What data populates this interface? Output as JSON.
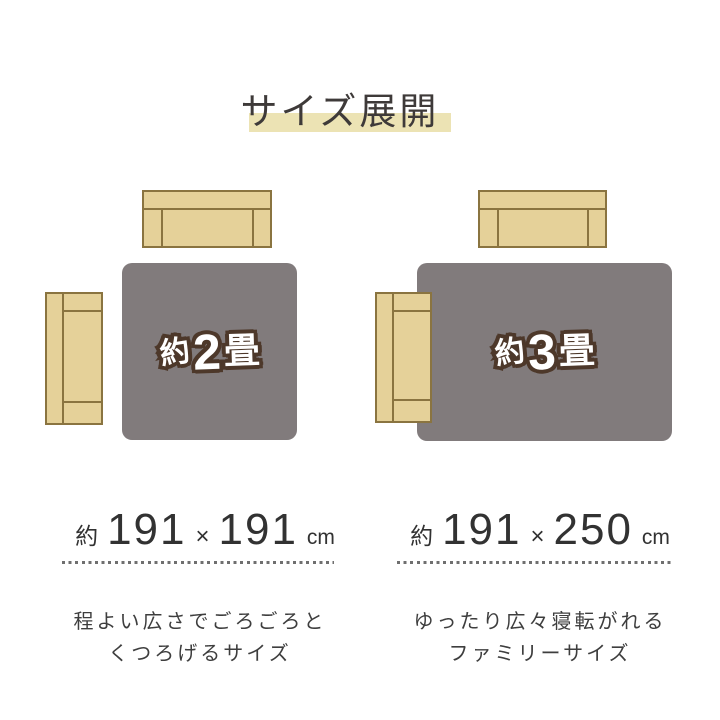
{
  "title": "サイズ展開",
  "colors": {
    "background": "#ffffff",
    "title_text": "#3e3a39",
    "title_highlight": "#ece3b4",
    "rug_fill": "#817b7c",
    "rug_label_fill": "#ffffff",
    "rug_label_outline": "#4d382a",
    "sofa_fill": "#e5d199",
    "sofa_border": "#8a7440",
    "size_text": "#323232",
    "dotted_line": "#6f6f6f",
    "description_text": "#3e3e3e"
  },
  "variants": [
    {
      "name": "2-tatami",
      "rug_label": {
        "prefix": "約",
        "number": "2",
        "suffix": "畳"
      },
      "size": {
        "prefix": "約",
        "width": "191",
        "times": "×",
        "depth": "191",
        "unit": "cm"
      },
      "description": [
        "程よい広さでごろごろと",
        "くつろげるサイズ"
      ]
    },
    {
      "name": "3-tatami",
      "rug_label": {
        "prefix": "約",
        "number": "3",
        "suffix": "畳"
      },
      "size": {
        "prefix": "約",
        "width": "191",
        "times": "×",
        "depth": "250",
        "unit": "cm"
      },
      "description": [
        "ゆったり広々寝転がれる",
        "ファミリーサイズ"
      ]
    }
  ]
}
